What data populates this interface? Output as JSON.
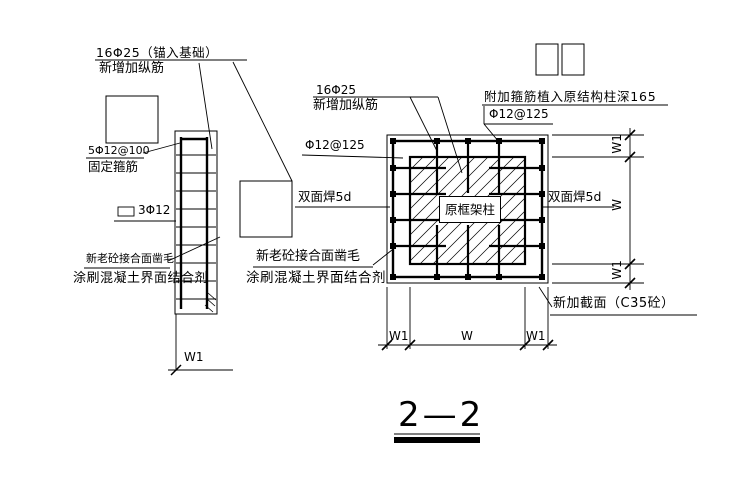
{
  "drawing_title": "2—2",
  "left_elevation": {
    "anchor_bars_spec": "16Φ25（锚入基础）",
    "anchor_bars_desc": "新增加纵筋",
    "fixing_stirrups_spec": "5Φ12@100",
    "fixing_stirrups_desc": "固定箍筋",
    "tie_bars": "3Φ12",
    "roughen_line1": "新老砼接合面凿毛",
    "roughen_line2": "涂刷混凝土界面结合剂",
    "dim_w1": "W1"
  },
  "plan": {
    "new_bars_spec": "16Φ25",
    "new_bars_desc": "新增加纵筋",
    "stirrup_spec_left": "Φ12@125",
    "added_stirrup_note": "附加箍筋植入原结构柱深165",
    "stirrup_spec_right": "Φ12@125",
    "weld_left": "双面焊5d",
    "weld_right": "双面焊5d",
    "original_column": "原框架柱",
    "new_section": "新加截面（C35砼）",
    "roughen_line1": "新老砼接合面凿毛",
    "roughen_line2": "涂刷混凝土界面结合剂",
    "dims_bottom": [
      "W1",
      "W",
      "W1"
    ],
    "dims_right": [
      "W1",
      "W",
      "W1"
    ]
  },
  "colors": {
    "line": "#000000",
    "background": "#ffffff"
  }
}
